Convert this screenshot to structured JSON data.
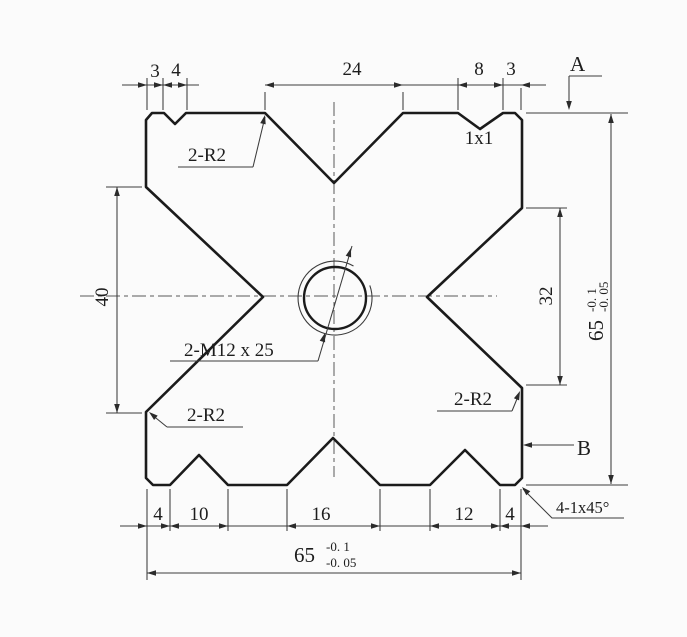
{
  "drawing": {
    "dims": {
      "top_left_offset": "3",
      "top_left_notch_width": "4",
      "top_v_width": "24",
      "top_right_notch_width": "8",
      "top_right_offset": "3",
      "left_v_height": "40",
      "right_v_height": "32",
      "bottom_left_offset": "4",
      "bottom_left_groove": "10",
      "bottom_center_groove": "16",
      "bottom_right_groove": "12",
      "bottom_right_offset": "4",
      "overall_height": {
        "value": "65",
        "upper": "-0. 1",
        "lower": "-0. 05"
      },
      "overall_width": {
        "value": "65",
        "upper": "-0. 1",
        "lower": "-0. 05"
      }
    },
    "labels": {
      "fillet_top_left": "2-R2",
      "fillet_bottom_left": "2-R2",
      "fillet_bottom_right": "2-R2",
      "notch_detail": "1x1",
      "thread_callout": "2-M12 x 25",
      "corner_chamfer": "4-1x45°",
      "datum_a": "A",
      "datum_b": "B"
    },
    "colors": {
      "outline": "#1b1b1b",
      "dimension": "#3c3c3c",
      "background": "#fbfbfb"
    }
  }
}
